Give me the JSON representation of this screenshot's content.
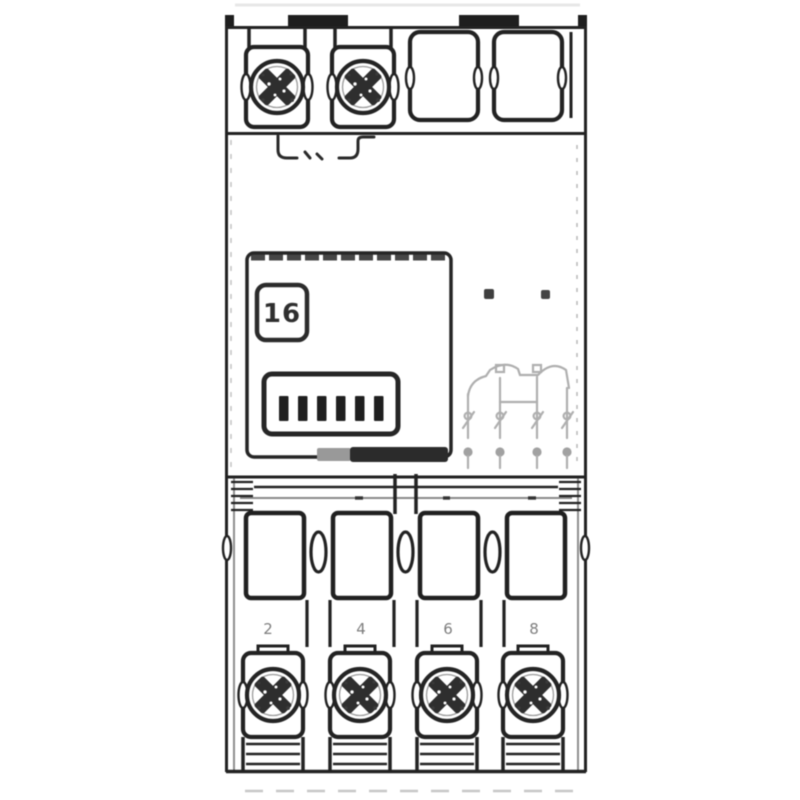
{
  "figure": {
    "subject": "contactor-front-view-line-drawing",
    "background_color": "#ffffff",
    "line_color": "#222222",
    "faint_print_color": "#8c8c8c"
  },
  "markings": {
    "badge_label": "16",
    "terminal_labels": [
      "2",
      "4",
      "6",
      "8"
    ]
  }
}
